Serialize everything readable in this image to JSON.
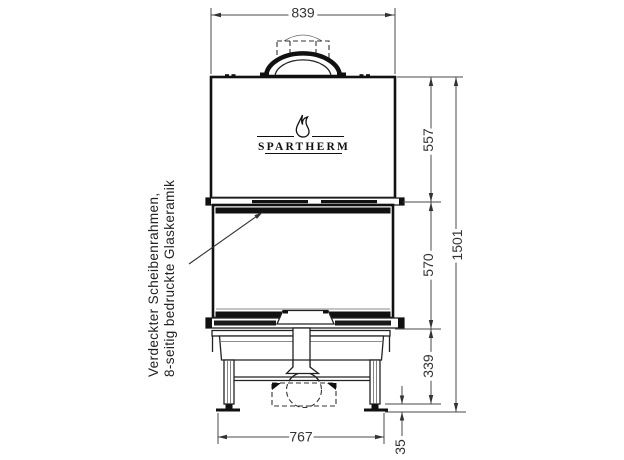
{
  "drawing": {
    "brand": "SPARTHERM",
    "note": {
      "line1": "Verdeckter Scheibenrahmen,",
      "line2": "8-seitig bedruckte Glaskeramik"
    },
    "dimensions": {
      "top_width_mm": "839",
      "upper_section_height_mm": "557",
      "glass_section_height_mm": "570",
      "base_section_height_mm": "339",
      "total_height_mm": "1501",
      "base_width_mm": "767",
      "foot_height_mm": "35"
    }
  }
}
